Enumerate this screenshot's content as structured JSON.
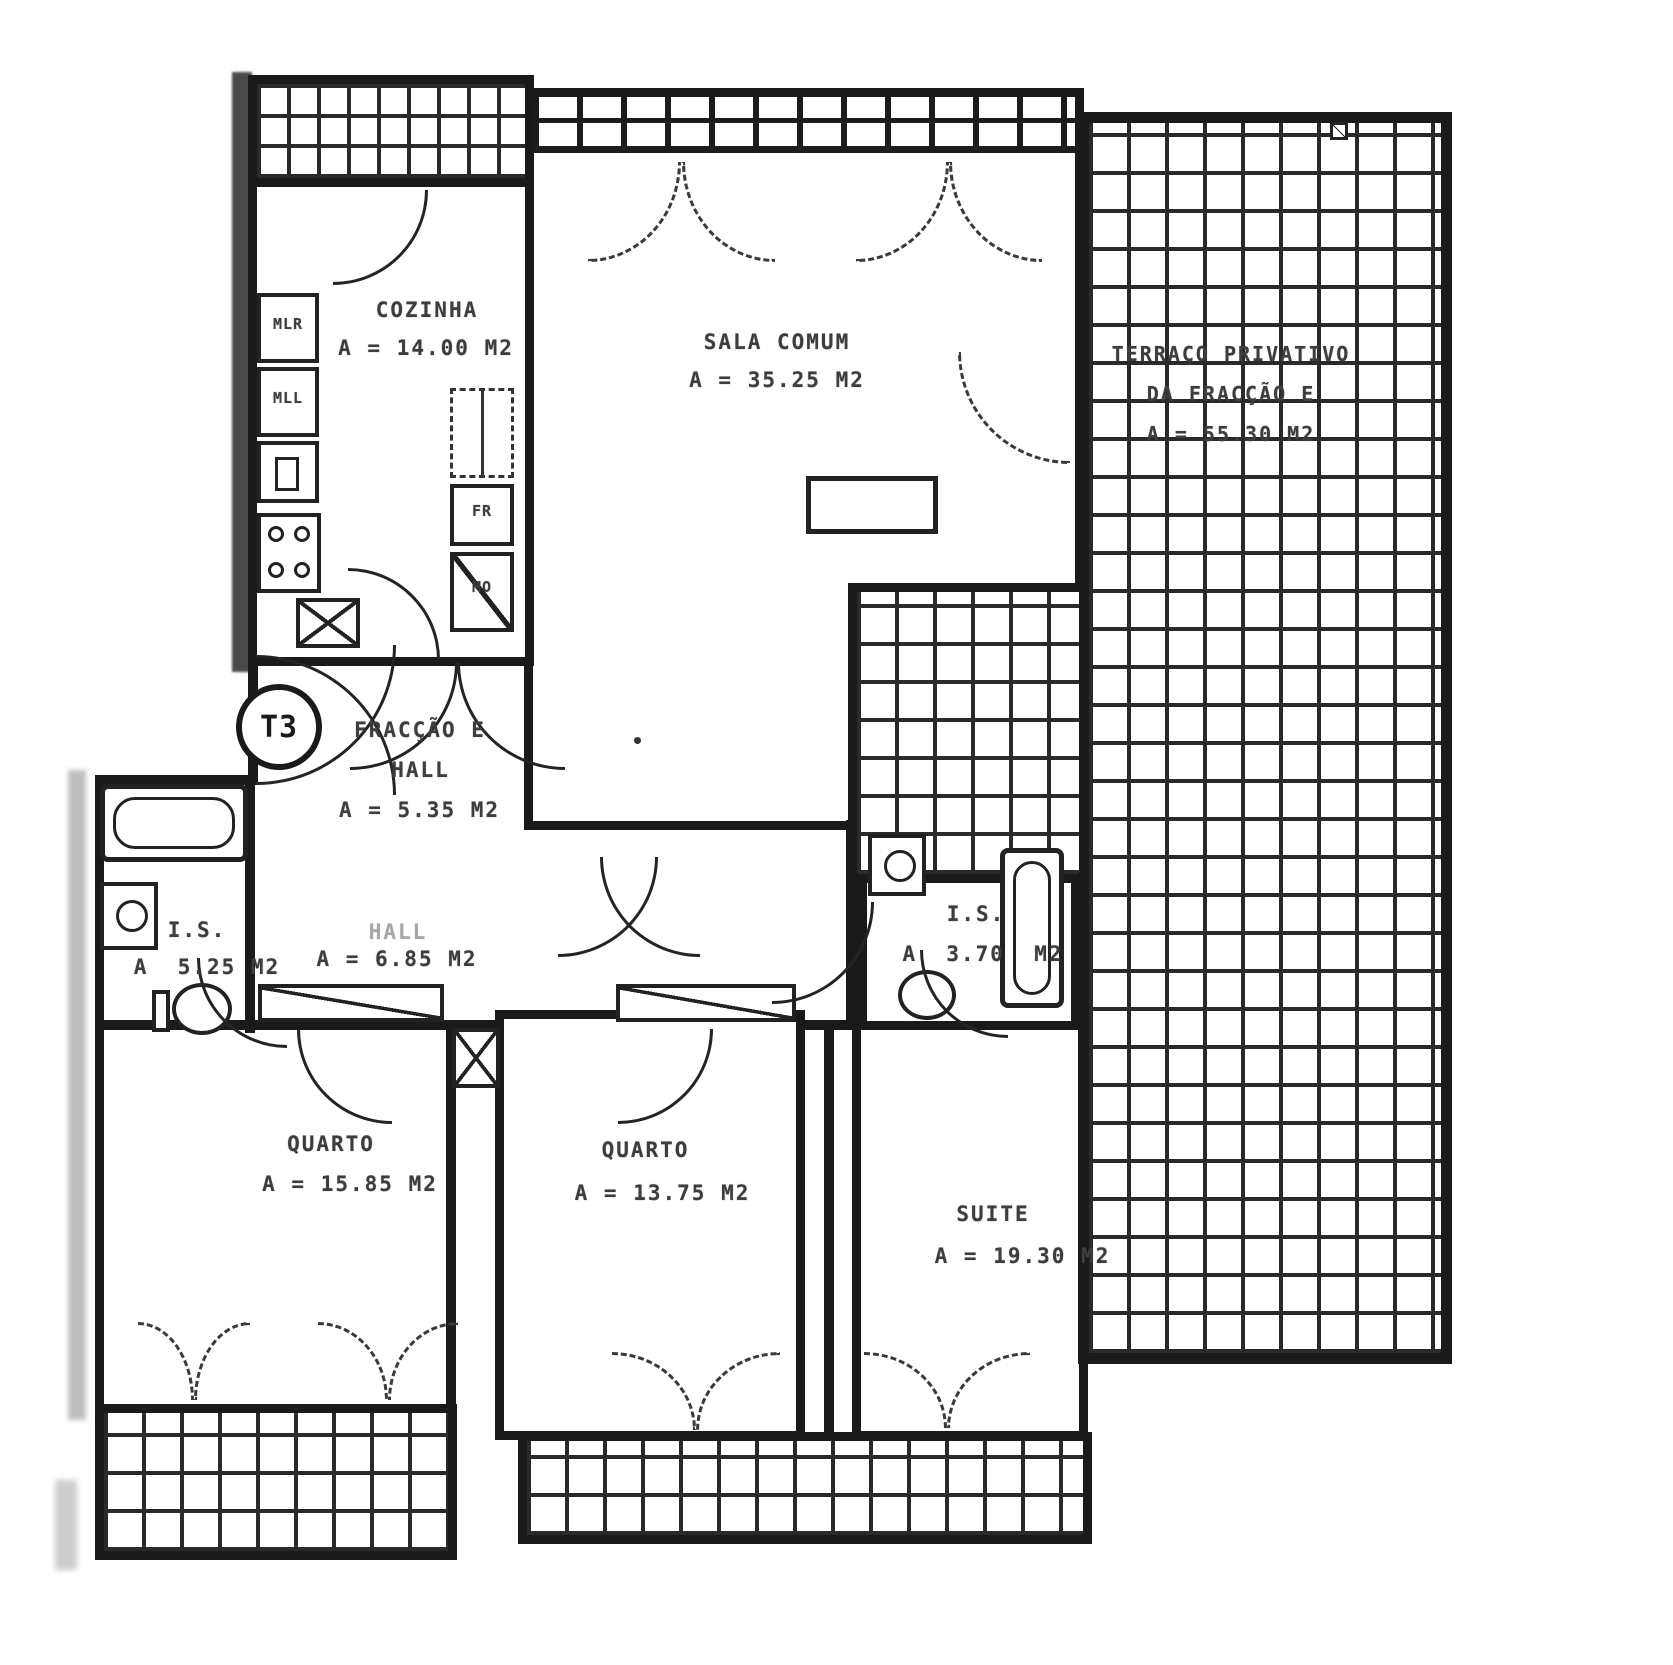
{
  "badge": {
    "label": "T3"
  },
  "rooms": {
    "cozinha": {
      "name": "COZINHA",
      "area": "A = 14.00 M2"
    },
    "sala": {
      "name": "SALA COMUM",
      "area": "A = 35.25 M2"
    },
    "terraco": {
      "line1": "TERRAÇO PRIVATIVO",
      "line2": "DA FRACÇÃO E",
      "area": "A = 55.30 M2"
    },
    "entrada": {
      "line1": "FRACÇÃO E",
      "line2": "HALL",
      "area": "A = 5.35 M2"
    },
    "hall": {
      "name": "HALL",
      "area": "A = 6.85 M2"
    },
    "is_esq": {
      "name": "I.S.",
      "area": "A  5.25 M2"
    },
    "is_suite": {
      "name": "I.S.",
      "area": "A  3.70  M2"
    },
    "quarto1": {
      "name": "QUARTO",
      "area": "A = 15.85 M2"
    },
    "quarto2": {
      "name": "QUARTO",
      "area": "A = 13.75 M2"
    },
    "suite": {
      "name": "SUITE",
      "area": "A = 19.30 M2"
    }
  },
  "fixtures": {
    "mlr": "MLR",
    "mll": "MLL",
    "fr": "FR",
    "mo": "MO"
  },
  "colors": {
    "ink": "#1a1a1a",
    "label": "#3d3d3d",
    "paper": "#ffffff"
  }
}
